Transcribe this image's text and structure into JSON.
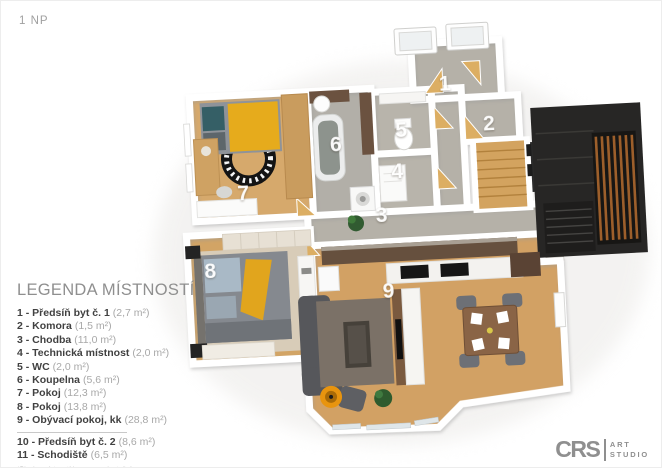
{
  "page": {
    "floor_label": "1 NP"
  },
  "legend": {
    "title": "LEGENDA MÍSTNOSTÍ",
    "items": [
      {
        "title": "1 - Předsíň byt č. 1",
        "area": "(2,7 m²)"
      },
      {
        "title": "2 - Komora",
        "area": "(1,5 m²)"
      },
      {
        "title": "3 - Chodba",
        "area": "(11,0 m²)"
      },
      {
        "title": "4 - Technická místnost",
        "area": "(2,0 m²)"
      },
      {
        "title": "5 - WC",
        "area": "(2,0 m²)"
      },
      {
        "title": "6 - Koupelna",
        "area": "(5,6 m²)"
      },
      {
        "title": "7 - Pokoj",
        "area": "(12,3 m²)"
      },
      {
        "title": "8 - Pokoj",
        "area": "(13,8 m²)"
      },
      {
        "title": "9 - Obývací pokoj, kk",
        "area": "(28,8 m²)"
      },
      {
        "title": "10 - Předsíň byt č. 2",
        "area": "(8,6 m²)"
      },
      {
        "title": "11 - Schodiště",
        "area": "(6,5 m²)"
      }
    ],
    "footnote": "*Plocha místností je pouze orientační"
  },
  "plan": {
    "room_labels": [
      "1",
      "2",
      "3",
      "4",
      "5",
      "6",
      "7",
      "8",
      "9"
    ],
    "colors": {
      "wood_floor": "#d2a164",
      "gray_floor": "#b5b1a8",
      "wall": "#ffffff",
      "dark_stair_box": "#272625",
      "wood_slats": "#9d5f2b",
      "accent_yellow": "#e6ab1c"
    }
  },
  "logo": {
    "brand": "CRS",
    "word1": "ART",
    "word2": "STUDIO"
  }
}
